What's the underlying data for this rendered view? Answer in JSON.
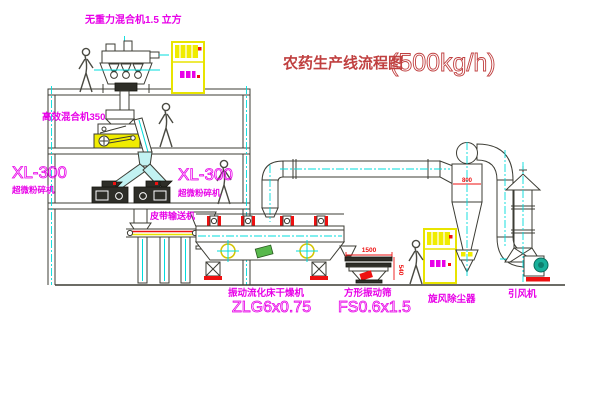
{
  "title": {
    "text": "农药生产线流程图",
    "capacity": "(500kg/h)"
  },
  "labels": {
    "top_mixer": "无重力混合机1.5 立方",
    "mid_mixer": "高效混合机350",
    "mill_left_model": "XL-300",
    "mill_left_name": "超微粉碎机",
    "mill_right_model": "XL-300",
    "mill_right_name": "超微粉碎机",
    "belt_conveyor": "皮带输送机",
    "dryer_name": "振动流化床干燥机",
    "dryer_model": "ZLG6x0.75",
    "sieve_name": "方形振动筛",
    "sieve_model": "FS0.6x1.5",
    "cyclone": "旋风除尘器",
    "fan": "引风机"
  },
  "dimensions": {
    "cyclone_inlet": "800",
    "sieve_length": "1500",
    "sieve_height": "540"
  },
  "colors": {
    "label_magenta": "#e800e8",
    "title_red": "#c04040",
    "dimension_red": "#ee1111",
    "highlight_yellow": "#f0ec00",
    "centerline_cyan": "#00dcdc",
    "line_dark": "#3c3c34"
  }
}
